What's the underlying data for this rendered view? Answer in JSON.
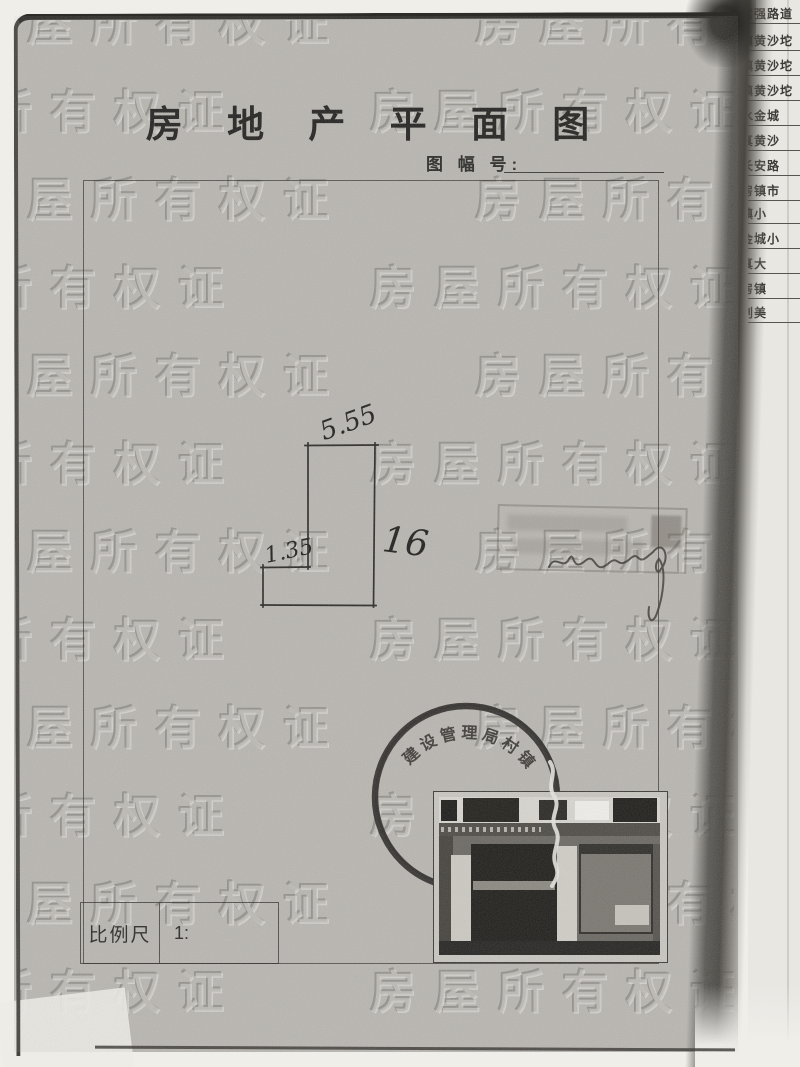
{
  "document": {
    "title": "房 地 产 平 面 图",
    "sheet_number": {
      "label": "图 幅 号:"
    },
    "watermark_text": "房屋所有权证",
    "floor_plan": {
      "dim_top": "5.55",
      "dim_left": "1.35",
      "dim_right": "16"
    },
    "round_stamp": {
      "arc_text": "建设管理局村镇"
    },
    "scale": {
      "label": "比例尺",
      "value": "1:"
    }
  },
  "side_page": {
    "lines": [
      "富强路道",
      "镇黄沙坨",
      "镇黄沙坨",
      "镇黄沙坨",
      "水金城",
      "真黄沙",
      "长安路",
      "房镇市",
      "镇小",
      "金城小",
      "真大",
      "房镇",
      "创美"
    ]
  },
  "colors": {
    "paper": "#b9b6b1",
    "ink": "#232220",
    "stamp_ink": "#2b2927",
    "strip_bg": "#e9e7e2"
  }
}
